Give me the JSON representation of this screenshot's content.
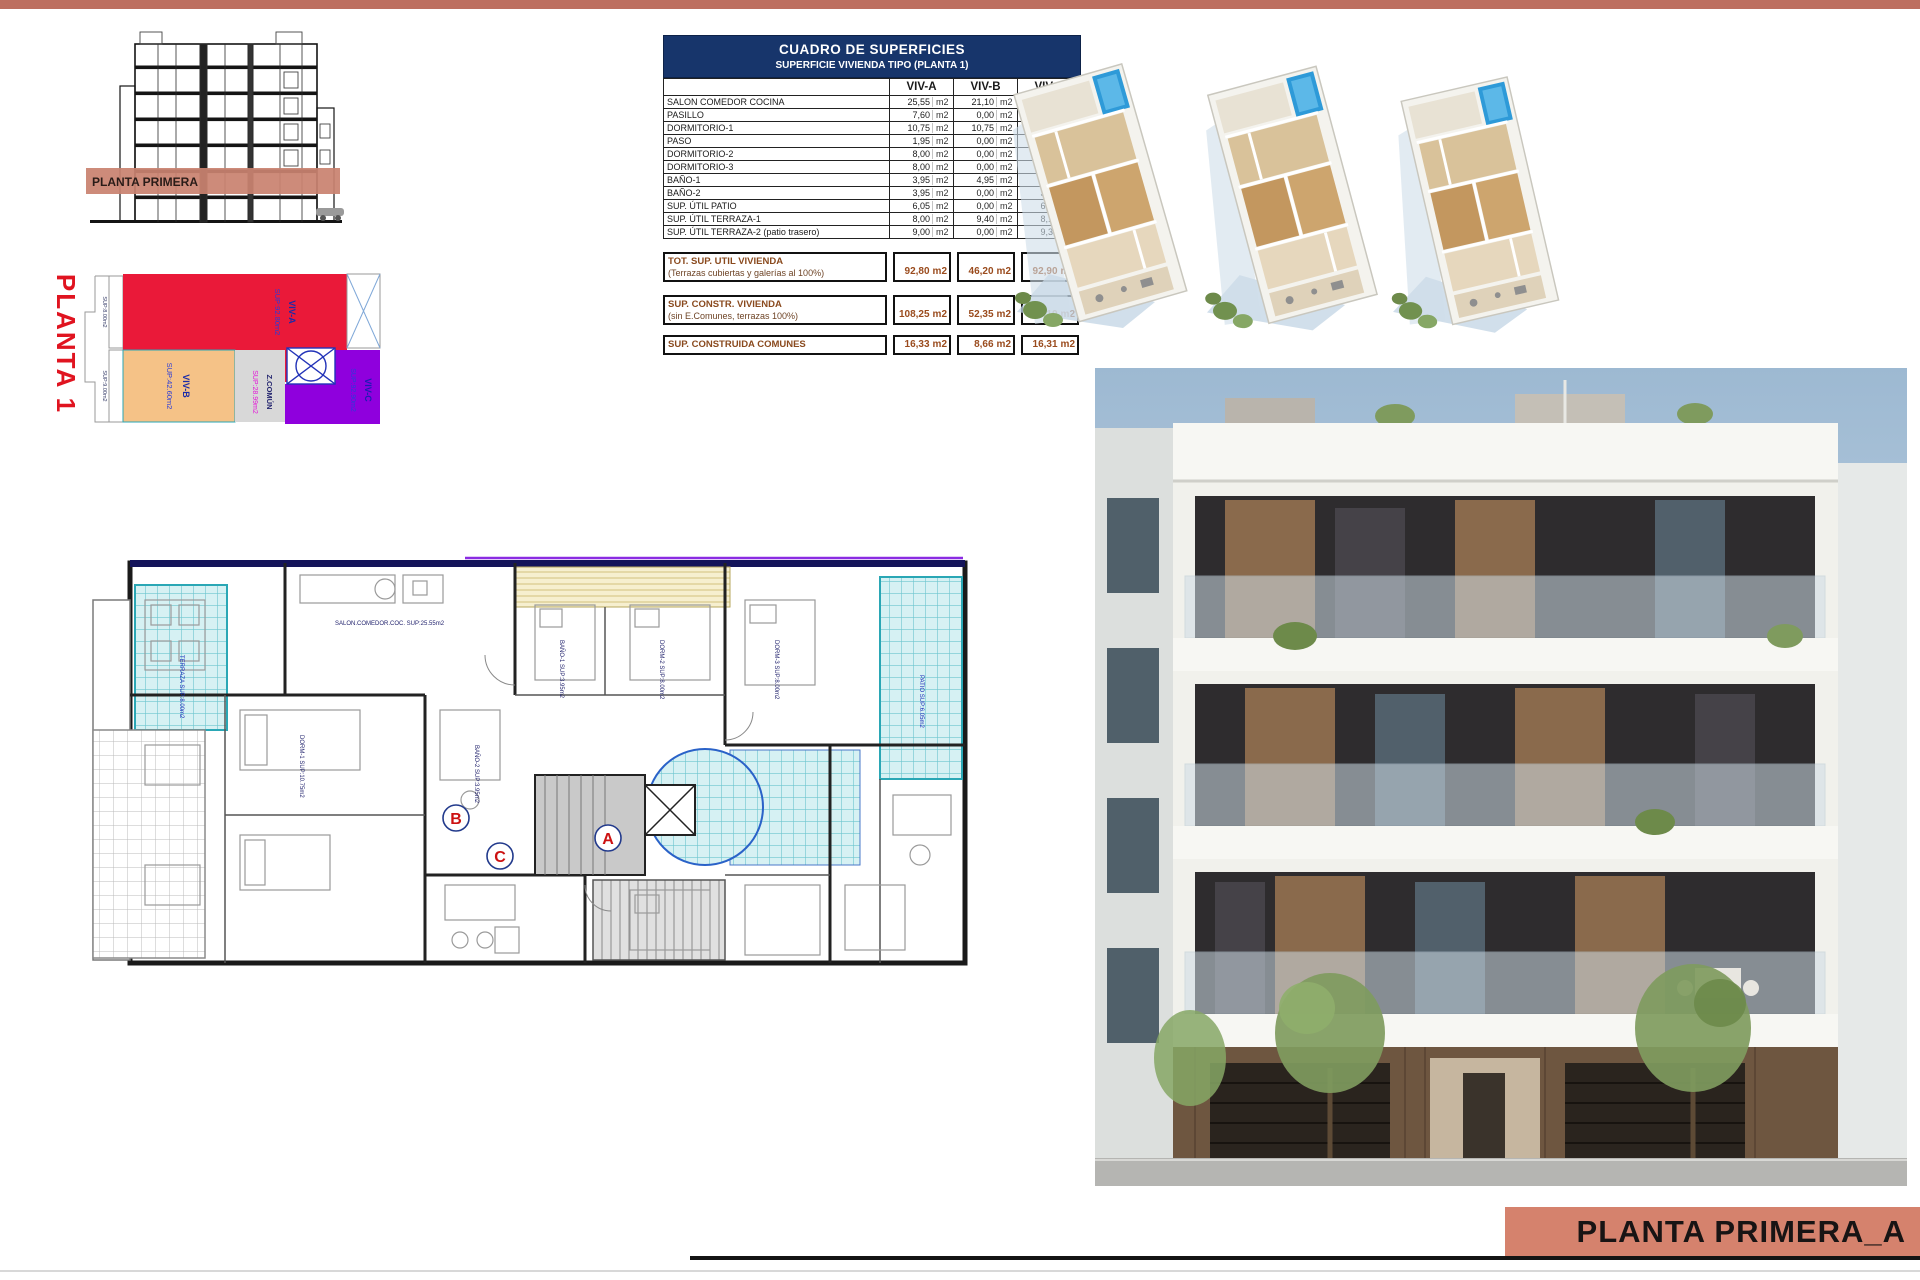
{
  "page": {
    "topbar_color": "#bd6f60",
    "bottom_plate_label": "PLANTA PRIMERA_A"
  },
  "section_drawing": {
    "band_label": "PLANTA PRIMERA",
    "band_color": "#c98270"
  },
  "colored_plan": {
    "title": "PLANTA 1",
    "title_color": "#e01420",
    "zones": [
      {
        "name": "VIV-A",
        "sup": "SUP:92.80m2",
        "color": "#ea1939"
      },
      {
        "name": "VIV-B",
        "sup": "SUP:42.60m2",
        "color": "#f5c287"
      },
      {
        "name": "Z.COMÚN",
        "sup": "SUP:28.99m2",
        "color": "#d8d8d8"
      },
      {
        "name": "VIV-C",
        "sup": "SUP:92.90m2",
        "color": "#8f00dd"
      }
    ],
    "side_labels": [
      "SUP:8.00m2",
      "SUP:9.00m2"
    ]
  },
  "table": {
    "title": "CUADRO DE SUPERFICIES",
    "subtitle": "SUPERFICIE VIVIENDA TIPO  (PLANTA 1)",
    "columns": [
      "VIV-A",
      "VIV-B",
      "VIV-C"
    ],
    "unit": "m2",
    "rows": [
      {
        "label": "SALON COMEDOR COCINA",
        "a": "25,55",
        "b": "21,10",
        "c": "25,25"
      },
      {
        "label": "PASILLO",
        "a": "7,60",
        "b": "0,00",
        "c": "7,60"
      },
      {
        "label": "DORMITORIO-1",
        "a": "10,75",
        "b": "10,75",
        "c": "10,75"
      },
      {
        "label": "PASO",
        "a": "1,95",
        "b": "0,00",
        "c": "1,95"
      },
      {
        "label": "DORMITORIO-2",
        "a": "8,00",
        "b": "0,00",
        "c": "8,00"
      },
      {
        "label": "DORMITORIO-3",
        "a": "8,00",
        "b": "0,00",
        "c": "8,00"
      },
      {
        "label": "BAÑO-1",
        "a": "3,95",
        "b": "4,95",
        "c": "3,95"
      },
      {
        "label": "BAÑO-2",
        "a": "3,95",
        "b": "0,00",
        "c": "3,95"
      },
      {
        "label": "SUP. ÚTIL PATIO",
        "a": "6,05",
        "b": "0,00",
        "c": "6,05"
      },
      {
        "label": "SUP. ÚTIL TERRAZA-1",
        "a": "8,00",
        "b": "9,40",
        "c": "8,10"
      },
      {
        "label": "SUP. ÚTIL TERRAZA-2 (patio trasero)",
        "a": "9,00",
        "b": "0,00",
        "c": "9,30"
      }
    ],
    "totals": [
      {
        "label": "TOT. SUP. UTIL VIVIENDA",
        "sublabel": "(Terrazas cubiertas y galerías al 100%)",
        "a": "92,80",
        "b": "46,20",
        "c": "92,90"
      },
      {
        "label": "SUP. CONSTR. VIVIENDA",
        "sublabel": "(sin E.Comunes, terrazas 100%)",
        "a": "108,25",
        "b": "52,35",
        "c": "109,10"
      },
      {
        "label": "SUP. CONSTRUIDA COMUNES",
        "sublabel": "",
        "a": "16,33",
        "b": "8,66",
        "c": "16,31"
      }
    ]
  },
  "floor_plan": {
    "markers": [
      "A",
      "B",
      "C"
    ],
    "room_labels": [
      "SALON.COMEDOR.COC. SUP:25.55m2",
      "DORM-1 SUP:10.75m2",
      "DORM-2 SUP:8.00m2",
      "DORM-3 SUP:8.00m2",
      "BAÑO-1 SUP:3.95m2",
      "BAÑO-2 SUP:3.95m2",
      "TERRAZA SUP:8.00m2",
      "PATIO SUP:6.05m2"
    ]
  }
}
